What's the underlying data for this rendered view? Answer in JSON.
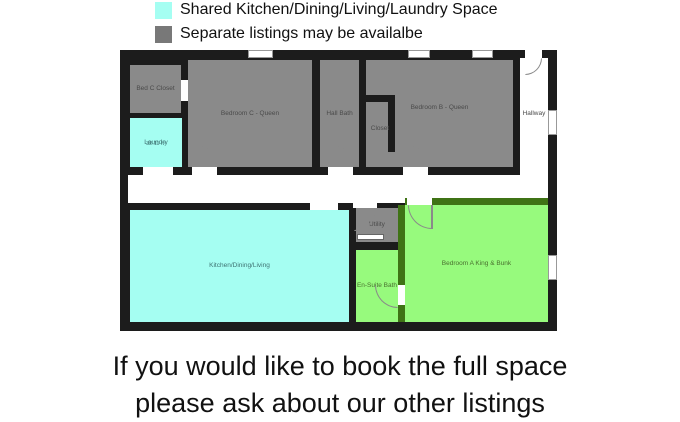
{
  "legend": {
    "items": [
      {
        "label": "Shared Kitchen/Dining/Living/Laundry Space",
        "color": "#a5fef2"
      },
      {
        "label": "Separate listings may be availalbe",
        "color": "#787878"
      }
    ]
  },
  "floorplan": {
    "zone_colors": {
      "shared": "#a5fef2",
      "separate_listing": "#8a8a8a",
      "bedroom_a_suite": "#97fa7d",
      "walls": "#1c1c1c",
      "suite_walls": "#3f7315"
    },
    "rooms": {
      "bed_c_closet": {
        "label": "Bed C Closet",
        "zone": "separate_listing"
      },
      "laundry": {
        "label": "Laundry",
        "area": "32.11 ft²",
        "zone": "shared"
      },
      "bedroom_c": {
        "label": "Bedroom C - Queen",
        "zone": "separate_listing"
      },
      "hall_bath": {
        "label": "Hall Bath",
        "zone": "separate_listing"
      },
      "closet": {
        "label": "Closet",
        "zone": "separate_listing"
      },
      "bedroom_b": {
        "label": "Bedroom B - Queen",
        "zone": "separate_listing"
      },
      "hallway": {
        "label": "Hallway",
        "zone": "neutral"
      },
      "kitchen": {
        "label": "Kitchen/Dining/Living",
        "zone": "shared"
      },
      "utility": {
        "label": "Utility",
        "zone": "separate_listing"
      },
      "en_suite_bath": {
        "label": "En-Suite Bath",
        "zone": "bedroom_a_suite"
      },
      "bedroom_a": {
        "label": "Bedroom A King & Bunk",
        "zone": "bedroom_a_suite"
      }
    }
  },
  "footer": {
    "line1": "If you would like to book the full space",
    "line2": "please ask about our other listings"
  }
}
